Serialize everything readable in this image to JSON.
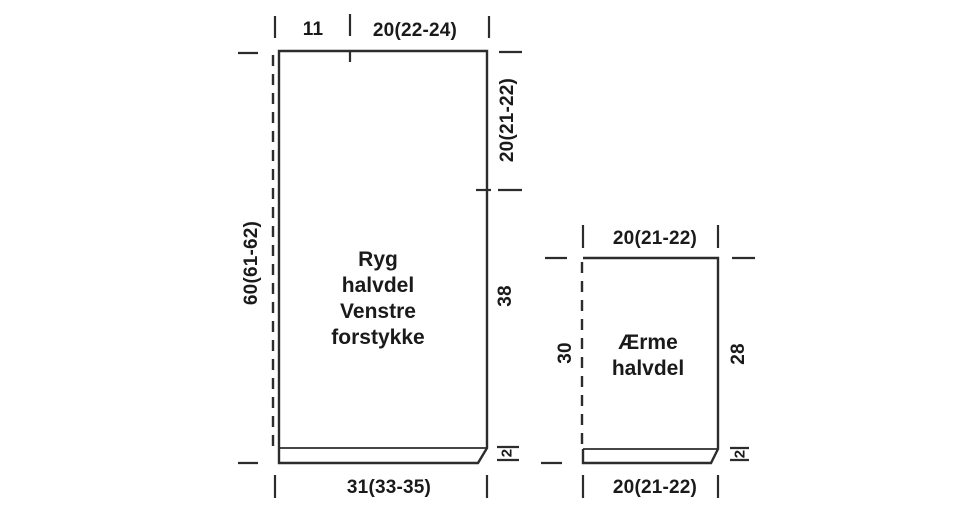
{
  "canvas": {
    "background_color": "#ffffff",
    "line_color": "#2c2c2c",
    "text_color": "#1a1a1a"
  },
  "body_piece": {
    "label_lines": [
      "Ryg",
      "halvdel",
      "Venstre",
      "forstykke"
    ],
    "dim_top_left": "11",
    "dim_top_right": "20(22-24)",
    "dim_right_top": "20(21-22)",
    "dim_right_mid": "38",
    "dim_right_hem": "2",
    "dim_left": "60(61-62)",
    "dim_bottom": "31(33-35)"
  },
  "sleeve_piece": {
    "label_lines": [
      "Ærme",
      "halvdel"
    ],
    "dim_top": "20(21-22)",
    "dim_left": "30",
    "dim_right": "28",
    "dim_right_hem": "2",
    "dim_bottom": "20(21-22)"
  }
}
